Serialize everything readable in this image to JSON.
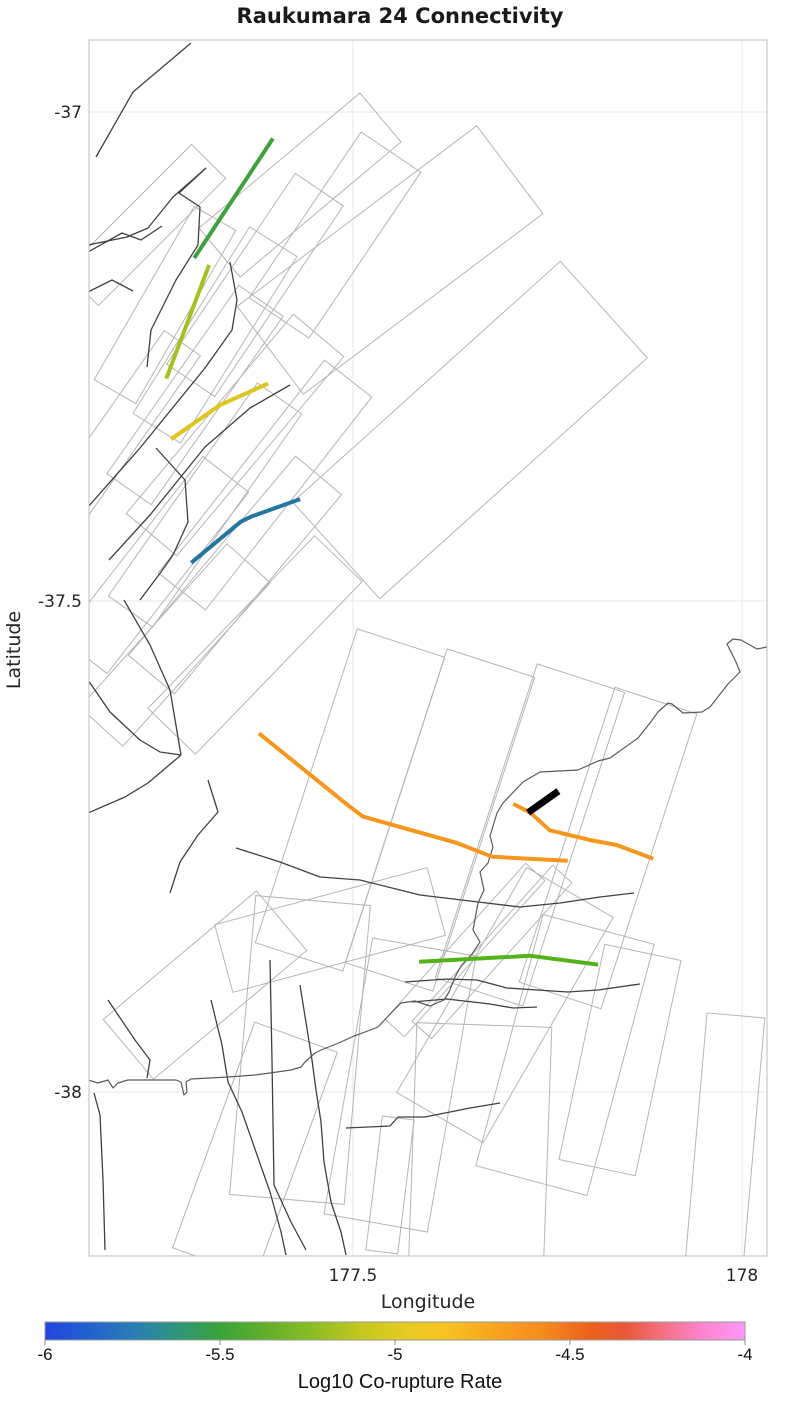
{
  "title": "Raukumara 24 Connectivity",
  "axes": {
    "xlabel": "Longitude",
    "ylabel": "Latitude",
    "xticks": [
      {
        "label": "177.5"
      },
      {
        "label": "178"
      }
    ],
    "yticks": [
      {
        "label": "-37"
      },
      {
        "label": "-37.5"
      },
      {
        "label": "-38"
      }
    ]
  },
  "colorbar": {
    "label": "Log10 Co-rupture Rate",
    "ticks": [
      {
        "label": "-6"
      },
      {
        "label": "-5.5"
      },
      {
        "label": "-5"
      },
      {
        "label": "-4.5"
      },
      {
        "label": "-4"
      }
    ],
    "range": [
      -6,
      -4
    ],
    "gradient": [
      {
        "pos": 0.0,
        "color": "#2345e0"
      },
      {
        "pos": 0.06,
        "color": "#215fd0"
      },
      {
        "pos": 0.13,
        "color": "#2a7fb2"
      },
      {
        "pos": 0.19,
        "color": "#2f9579"
      },
      {
        "pos": 0.25,
        "color": "#3aa339"
      },
      {
        "pos": 0.31,
        "color": "#5ead2c"
      },
      {
        "pos": 0.38,
        "color": "#8abd24"
      },
      {
        "pos": 0.45,
        "color": "#c3c81f"
      },
      {
        "pos": 0.52,
        "color": "#e8cb20"
      },
      {
        "pos": 0.57,
        "color": "#f6c31e"
      },
      {
        "pos": 0.64,
        "color": "#f6a61e"
      },
      {
        "pos": 0.71,
        "color": "#f58b1e"
      },
      {
        "pos": 0.78,
        "color": "#ec611c"
      },
      {
        "pos": 0.83,
        "color": "#e8583a"
      },
      {
        "pos": 0.88,
        "color": "#f4707e"
      },
      {
        "pos": 0.94,
        "color": "#fb85cf"
      },
      {
        "pos": 1.0,
        "color": "#ff97f8"
      }
    ]
  },
  "chart_data": {
    "type": "map",
    "title": "Raukumara 24 Connectivity",
    "xlabel": "Longitude",
    "ylabel": "Latitude",
    "xlim": [
      177.16,
      178.03
    ],
    "ylim": [
      -38.17,
      -36.93
    ],
    "xticks": [
      177.5,
      178.0
    ],
    "yticks": [
      -37.0,
      -37.5,
      -38.0
    ],
    "grid": true,
    "colorbar_label": "Log10 Co-rupture Rate",
    "colorbar_range": [
      -6,
      -4
    ],
    "segments": [
      {
        "name": "co-rupture-segment-1",
        "color": "#3da23c",
        "approx_log10_rate": -5.5,
        "lw": 4,
        "points": [
          [
            177.397,
            -37.027
          ],
          [
            177.296,
            -37.149
          ]
        ]
      },
      {
        "name": "co-rupture-segment-2",
        "color": "#a6c021",
        "approx_log10_rate": -5.2,
        "lw": 4,
        "points": [
          [
            177.315,
            -37.156
          ],
          [
            177.26,
            -37.272
          ]
        ]
      },
      {
        "name": "co-rupture-segment-3",
        "color": "#ddc61f",
        "approx_log10_rate": -5.05,
        "lw": 4,
        "points": [
          [
            177.391,
            -37.277
          ],
          [
            177.329,
            -37.299
          ],
          [
            177.266,
            -37.334
          ]
        ]
      },
      {
        "name": "co-rupture-segment-4",
        "color": "#23779e",
        "approx_log10_rate": -5.75,
        "lw": 4,
        "points": [
          [
            177.432,
            -37.395
          ],
          [
            177.369,
            -37.413
          ],
          [
            177.356,
            -37.418
          ],
          [
            177.292,
            -37.46
          ]
        ]
      },
      {
        "name": "co-rupture-segment-5",
        "color": "#f5961e",
        "approx_log10_rate": -4.65,
        "lw": 4,
        "points": [
          [
            177.379,
            -37.634
          ],
          [
            177.496,
            -37.709
          ],
          [
            177.513,
            -37.719
          ],
          [
            177.634,
            -37.746
          ],
          [
            177.679,
            -37.76
          ],
          [
            177.776,
            -37.764
          ]
        ]
      },
      {
        "name": "co-rupture-segment-6",
        "color": "#f5961e",
        "approx_log10_rate": -4.65,
        "lw": 4,
        "points": [
          [
            177.706,
            -37.706
          ],
          [
            177.728,
            -37.715
          ],
          [
            177.753,
            -37.733
          ],
          [
            177.805,
            -37.743
          ],
          [
            177.839,
            -37.748
          ],
          [
            177.886,
            -37.762
          ]
        ]
      },
      {
        "name": "co-rupture-segment-7",
        "color": "#54b318",
        "approx_log10_rate": -5.4,
        "lw": 4,
        "points": [
          [
            177.585,
            -37.867
          ],
          [
            177.728,
            -37.861
          ],
          [
            177.815,
            -37.87
          ]
        ]
      },
      {
        "name": "target-fault-raukumara-24",
        "color": "#000000",
        "approx_log10_rate": null,
        "lw": 7,
        "points": [
          [
            177.725,
            -37.715
          ],
          [
            177.764,
            -37.693
          ]
        ]
      }
    ]
  },
  "map_geometry": {
    "frame_color": "#bdbdbd",
    "grid_color": "#ececec",
    "patch_color": "#b5b5b5",
    "trace_color": "#404040",
    "coast_color": "#5a5a5a",
    "patches": [
      {
        "cx": 300,
        "cy": 185,
        "a": -40,
        "l": 210,
        "w": 64
      },
      {
        "cx": 335,
        "cy": 235,
        "a": -56,
        "l": 200,
        "w": 72
      },
      {
        "cx": 255,
        "cy": 285,
        "a": -56,
        "l": 230,
        "w": 58
      },
      {
        "cx": 215,
        "cy": 335,
        "a": -58,
        "l": 220,
        "w": 56
      },
      {
        "cx": 195,
        "cy": 395,
        "a": -55,
        "l": 230,
        "w": 54
      },
      {
        "cx": 235,
        "cy": 435,
        "a": -50,
        "l": 260,
        "w": 66
      },
      {
        "cx": 265,
        "cy": 485,
        "a": -52,
        "l": 270,
        "w": 60
      },
      {
        "cx": 205,
        "cy": 505,
        "a": -55,
        "l": 260,
        "w": 54
      },
      {
        "cx": 165,
        "cy": 305,
        "a": -60,
        "l": 200,
        "w": 48
      },
      {
        "cx": 145,
        "cy": 225,
        "a": -45,
        "l": 180,
        "w": 48
      },
      {
        "cx": 125,
        "cy": 425,
        "a": -55,
        "l": 200,
        "w": 44
      },
      {
        "cx": 155,
        "cy": 565,
        "a": -52,
        "l": 230,
        "w": 58
      },
      {
        "cx": 235,
        "cy": 575,
        "a": -50,
        "l": 260,
        "w": 60
      },
      {
        "cx": 175,
        "cy": 645,
        "a": -48,
        "l": 220,
        "w": 58
      },
      {
        "cx": 255,
        "cy": 645,
        "a": -46,
        "l": 240,
        "w": 66
      },
      {
        "cx": 390,
        "cy": 260,
        "a": -37,
        "l": 300,
        "w": 110
      },
      {
        "cx": 470,
        "cy": 430,
        "a": -42,
        "l": 360,
        "w": 130
      },
      {
        "cx": 350,
        "cy": 800,
        "a": -72,
        "l": 330,
        "w": 92
      },
      {
        "cx": 440,
        "cy": 820,
        "a": -72,
        "l": 330,
        "w": 92
      },
      {
        "cx": 530,
        "cy": 835,
        "a": -72,
        "l": 330,
        "w": 92
      },
      {
        "cx": 608,
        "cy": 848,
        "a": -72,
        "l": 310,
        "w": 86
      },
      {
        "cx": 300,
        "cy": 1050,
        "a": -85,
        "l": 300,
        "w": 115
      },
      {
        "cx": 400,
        "cy": 1085,
        "a": -80,
        "l": 280,
        "w": 105
      },
      {
        "cx": 505,
        "cy": 1005,
        "a": -60,
        "l": 260,
        "w": 100
      },
      {
        "cx": 565,
        "cy": 1055,
        "a": -75,
        "l": 260,
        "w": 115
      },
      {
        "cx": 480,
        "cy": 1150,
        "a": -88,
        "l": 250,
        "w": 135
      },
      {
        "cx": 255,
        "cy": 1150,
        "a": -70,
        "l": 240,
        "w": 88
      },
      {
        "cx": 620,
        "cy": 1060,
        "a": -78,
        "l": 220,
        "w": 78
      },
      {
        "cx": 725,
        "cy": 1140,
        "a": -85,
        "l": 250,
        "w": 58
      },
      {
        "cx": 390,
        "cy": 1185,
        "a": -83,
        "l": 135,
        "w": 32
      },
      {
        "cx": 465,
        "cy": 950,
        "a": -48,
        "l": 210,
        "w": 26
      },
      {
        "cx": 492,
        "cy": 952,
        "a": -48,
        "l": 210,
        "w": 26
      },
      {
        "cx": 205,
        "cy": 985,
        "a": -40,
        "l": 200,
        "w": 78
      },
      {
        "cx": 330,
        "cy": 930,
        "a": -15,
        "l": 220,
        "w": 70
      }
    ],
    "traces": [
      [
        [
          191,
          43
        ],
        [
          133,
          92
        ],
        [
          96,
          157
        ]
      ],
      [
        [
          206,
          168
        ],
        [
          179,
          193
        ],
        [
          200,
          207
        ],
        [
          198,
          245
        ],
        [
          176,
          280
        ],
        [
          151,
          330
        ],
        [
          147,
          367
        ]
      ],
      [
        [
          206,
          168
        ],
        [
          173,
          197
        ],
        [
          148,
          228
        ],
        [
          127,
          237
        ],
        [
          88,
          245
        ]
      ],
      [
        [
          88,
          252
        ],
        [
          122,
          233
        ],
        [
          141,
          240
        ],
        [
          162,
          226
        ]
      ],
      [
        [
          88,
          292
        ],
        [
          112,
          280
        ],
        [
          133,
          291
        ]
      ],
      [
        [
          88,
          507
        ],
        [
          140,
          448
        ],
        [
          205,
          368
        ],
        [
          232,
          330
        ],
        [
          237,
          300
        ],
        [
          230,
          262
        ]
      ],
      [
        [
          109,
          560
        ],
        [
          150,
          515
        ],
        [
          205,
          447
        ],
        [
          250,
          408
        ],
        [
          290,
          385
        ]
      ],
      [
        [
          156,
          448
        ],
        [
          185,
          480
        ],
        [
          188,
          522
        ],
        [
          173,
          555
        ],
        [
          161,
          572
        ],
        [
          140,
          600
        ]
      ],
      [
        [
          124,
          600
        ],
        [
          150,
          645
        ],
        [
          170,
          690
        ],
        [
          181,
          755
        ]
      ],
      [
        [
          181,
          755
        ],
        [
          148,
          783
        ],
        [
          125,
          797
        ],
        [
          88,
          813
        ]
      ],
      [
        [
          88,
          680
        ],
        [
          110,
          712
        ],
        [
          140,
          740
        ],
        [
          160,
          752
        ],
        [
          181,
          755
        ]
      ],
      [
        [
          208,
          780
        ],
        [
          218,
          812
        ],
        [
          198,
          835
        ],
        [
          180,
          862
        ],
        [
          170,
          893
        ]
      ],
      [
        [
          236,
          848
        ],
        [
          280,
          862
        ],
        [
          320,
          877
        ],
        [
          360,
          880
        ],
        [
          420,
          895
        ],
        [
          470,
          901
        ],
        [
          520,
          907
        ],
        [
          560,
          903
        ],
        [
          600,
          897
        ],
        [
          634,
          893
        ]
      ],
      [
        [
          94,
          1093
        ],
        [
          100,
          1115
        ],
        [
          103,
          1180
        ],
        [
          105,
          1250
        ]
      ],
      [
        [
          108,
          1000
        ],
        [
          135,
          1040
        ],
        [
          150,
          1060
        ],
        [
          147,
          1078
        ]
      ],
      [
        [
          211,
          1000
        ],
        [
          222,
          1045
        ],
        [
          228,
          1082
        ],
        [
          242,
          1112
        ],
        [
          256,
          1152
        ],
        [
          270,
          1192
        ],
        [
          281,
          1232
        ],
        [
          286,
          1255
        ]
      ],
      [
        [
          270,
          960
        ],
        [
          272,
          1060
        ],
        [
          274,
          1185
        ],
        [
          291,
          1222
        ],
        [
          306,
          1250
        ]
      ],
      [
        [
          300,
          985
        ],
        [
          312,
          1060
        ],
        [
          316,
          1090
        ],
        [
          321,
          1122
        ],
        [
          324,
          1162
        ],
        [
          331,
          1202
        ],
        [
          341,
          1232
        ],
        [
          346,
          1255
        ]
      ],
      [
        [
          405,
          982
        ],
        [
          447,
          979
        ],
        [
          477,
          980
        ],
        [
          507,
          988
        ],
        [
          537,
          990
        ],
        [
          568,
          992
        ],
        [
          598,
          990
        ],
        [
          640,
          984
        ]
      ],
      [
        [
          412,
          1002
        ],
        [
          447,
          999
        ],
        [
          490,
          1004
        ],
        [
          513,
          1008
        ],
        [
          537,
          1007
        ]
      ],
      [
        [
          346,
          1128
        ],
        [
          390,
          1126
        ],
        [
          398,
          1117
        ],
        [
          425,
          1117
        ],
        [
          470,
          1108
        ],
        [
          500,
          1103
        ]
      ]
    ],
    "coastline": [
      [
        767,
        647
      ],
      [
        757,
        649
      ],
      [
        741,
        640
      ],
      [
        733,
        639
      ],
      [
        727,
        644
      ],
      [
        736,
        662
      ],
      [
        740,
        672
      ],
      [
        728,
        684
      ],
      [
        710,
        707
      ],
      [
        702,
        712
      ],
      [
        683,
        713
      ],
      [
        672,
        704
      ],
      [
        668,
        703
      ],
      [
        658,
        712
      ],
      [
        650,
        723
      ],
      [
        638,
        738
      ],
      [
        610,
        758
      ],
      [
        598,
        761
      ],
      [
        578,
        770
      ],
      [
        540,
        772
      ],
      [
        523,
        782
      ],
      [
        503,
        803
      ],
      [
        497,
        813
      ],
      [
        490,
        836
      ],
      [
        493,
        847
      ],
      [
        488,
        863
      ],
      [
        480,
        872
      ],
      [
        484,
        890
      ],
      [
        478,
        903
      ],
      [
        473,
        930
      ],
      [
        480,
        942
      ],
      [
        472,
        954
      ],
      [
        461,
        966
      ],
      [
        455,
        977
      ],
      [
        449,
        992
      ],
      [
        444,
        1000
      ],
      [
        430,
        1006
      ],
      [
        415,
        1001
      ],
      [
        401,
        1003
      ],
      [
        393,
        1011
      ],
      [
        378,
        1027
      ],
      [
        365,
        1032
      ],
      [
        354,
        1036
      ],
      [
        341,
        1042
      ],
      [
        321,
        1050
      ],
      [
        315,
        1053
      ],
      [
        305,
        1062
      ],
      [
        301,
        1067
      ],
      [
        291,
        1070
      ],
      [
        270,
        1073
      ],
      [
        255,
        1075
      ],
      [
        228,
        1077
      ],
      [
        191,
        1079
      ],
      [
        186,
        1082
      ],
      [
        187,
        1092
      ],
      [
        184,
        1095
      ],
      [
        181,
        1082
      ],
      [
        176,
        1080
      ],
      [
        165,
        1080
      ],
      [
        128,
        1080
      ],
      [
        118,
        1083
      ],
      [
        113,
        1088
      ],
      [
        108,
        1080
      ],
      [
        98,
        1083
      ],
      [
        88,
        1080
      ]
    ]
  }
}
